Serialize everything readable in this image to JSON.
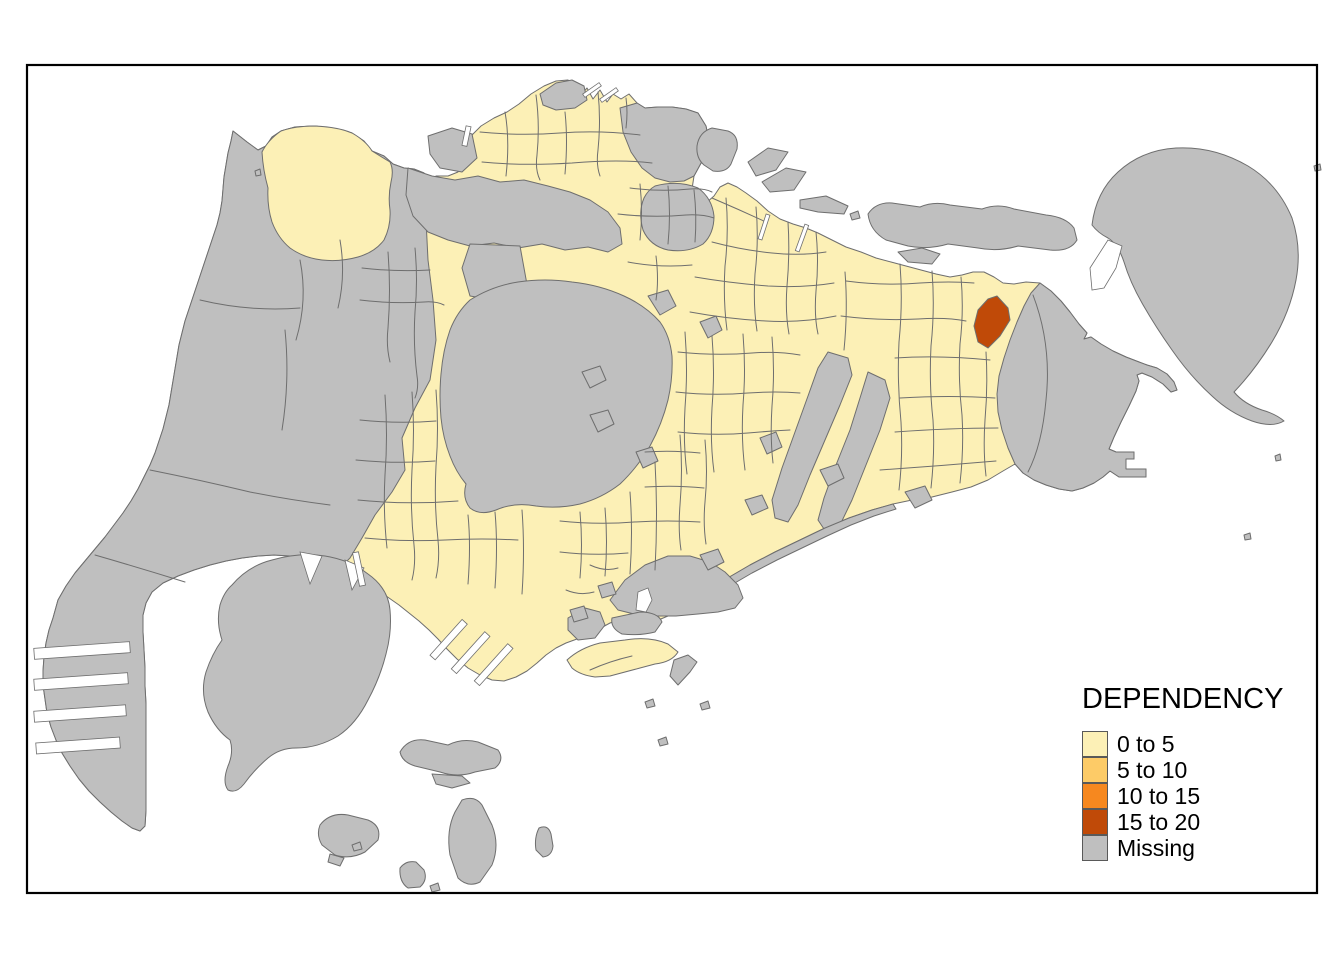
{
  "colors": {
    "background": "#ffffff",
    "water": "#ffffff",
    "frame": "#000000",
    "text": "#000000",
    "boundary": "#6e6e6e",
    "swatch_border": "#595959",
    "class_0_to_5": "#fcf0b6",
    "class_5_to_10": "#fdcb67",
    "class_10_to_15": "#f6881f",
    "class_15_to_20": "#c04a08",
    "missing": "#bfbfbf"
  },
  "legend": {
    "title": "DEPENDENCY",
    "items": [
      {
        "label": "0 to 5",
        "color": "#fcf0b6"
      },
      {
        "label": "5 to 10",
        "color": "#fdcb67"
      },
      {
        "label": "10 to 15",
        "color": "#f6881f"
      },
      {
        "label": "15 to 20",
        "color": "#c04a08"
      },
      {
        "label": "Missing",
        "color": "#bfbfbf"
      }
    ]
  },
  "map": {
    "classes_visible_on_map": [
      "0 to 5",
      "15 to 20",
      "Missing"
    ],
    "highlight_class": "15 to 20"
  }
}
